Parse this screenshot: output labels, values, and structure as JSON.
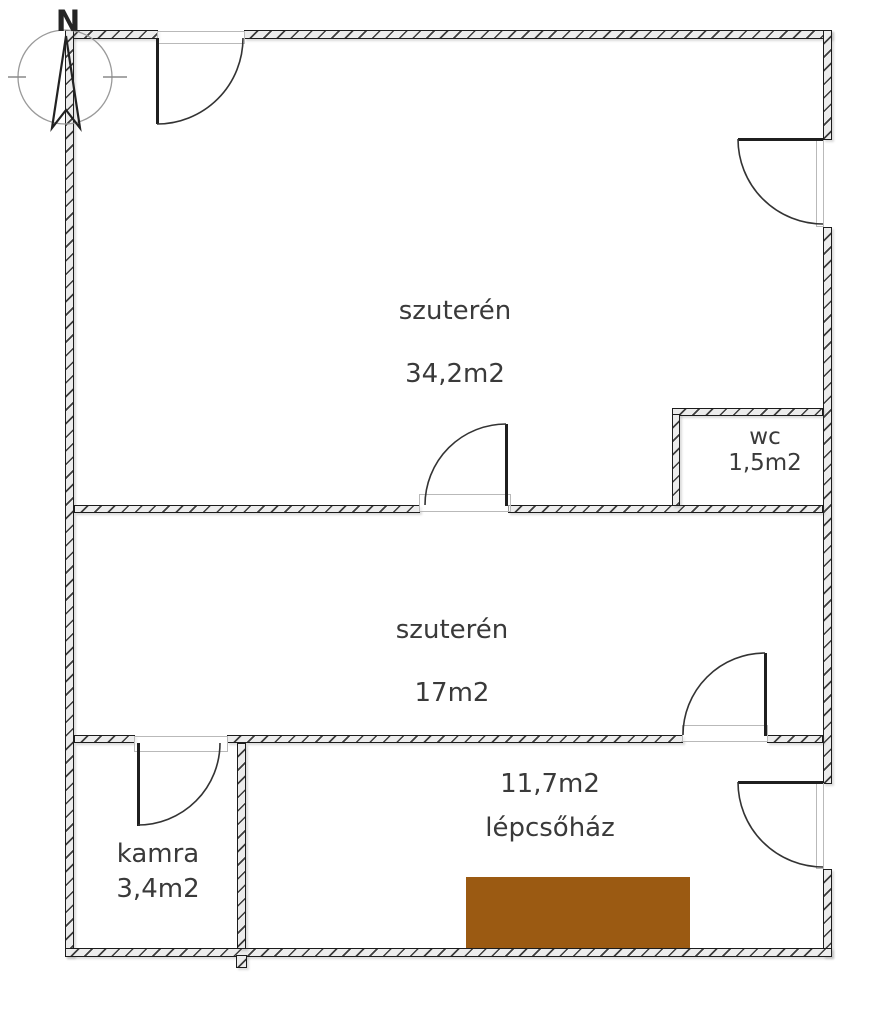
{
  "plan_title": "basement floor plan",
  "compass": {
    "north_label": "N"
  },
  "rooms": [
    {
      "name": "szuterén",
      "area": "34,2m2"
    },
    {
      "name": "wc",
      "area": "1,5m2"
    },
    {
      "name": "szuterén",
      "area": "17m2"
    },
    {
      "name": "kamra",
      "area": "3,4m2"
    },
    {
      "name": "lépcsőház",
      "area": "11,7m2"
    }
  ],
  "colors": {
    "stairs": "#9b5a12",
    "wall-fill": "#ececec",
    "hatch": "#3d3d3d",
    "line": "#1c1c1c",
    "text": "#3a3a3a"
  }
}
